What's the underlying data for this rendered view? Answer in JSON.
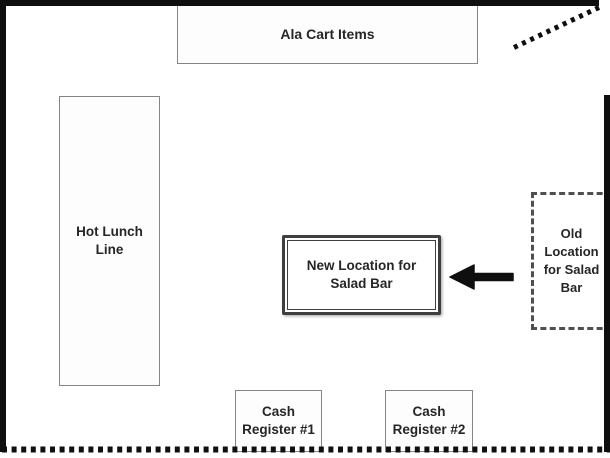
{
  "floor_plan": {
    "boxes": {
      "ala_cart": {
        "lines": [
          "Ala Cart Items"
        ]
      },
      "hot_lunch": {
        "lines": [
          "Hot Lunch",
          "Line"
        ]
      },
      "new_location": {
        "lines": [
          "New Location for",
          "Salad Bar"
        ]
      },
      "old_location": {
        "lines": [
          "Old",
          "Location",
          "for Salad",
          "Bar"
        ]
      },
      "cash_register_1": {
        "lines": [
          "Cash",
          "Register #1"
        ]
      },
      "cash_register_2": {
        "lines": [
          "Cash",
          "Register #2"
        ]
      }
    },
    "icons": {
      "arrow": "left-arrow"
    },
    "colors": {
      "wall": "#0f0f0f",
      "thin_box_border": "#858585",
      "emphasis_border": "#3f3f3f",
      "dashed_border": "#4f4f4f",
      "text": "#262626",
      "background": "#ffffff"
    }
  }
}
